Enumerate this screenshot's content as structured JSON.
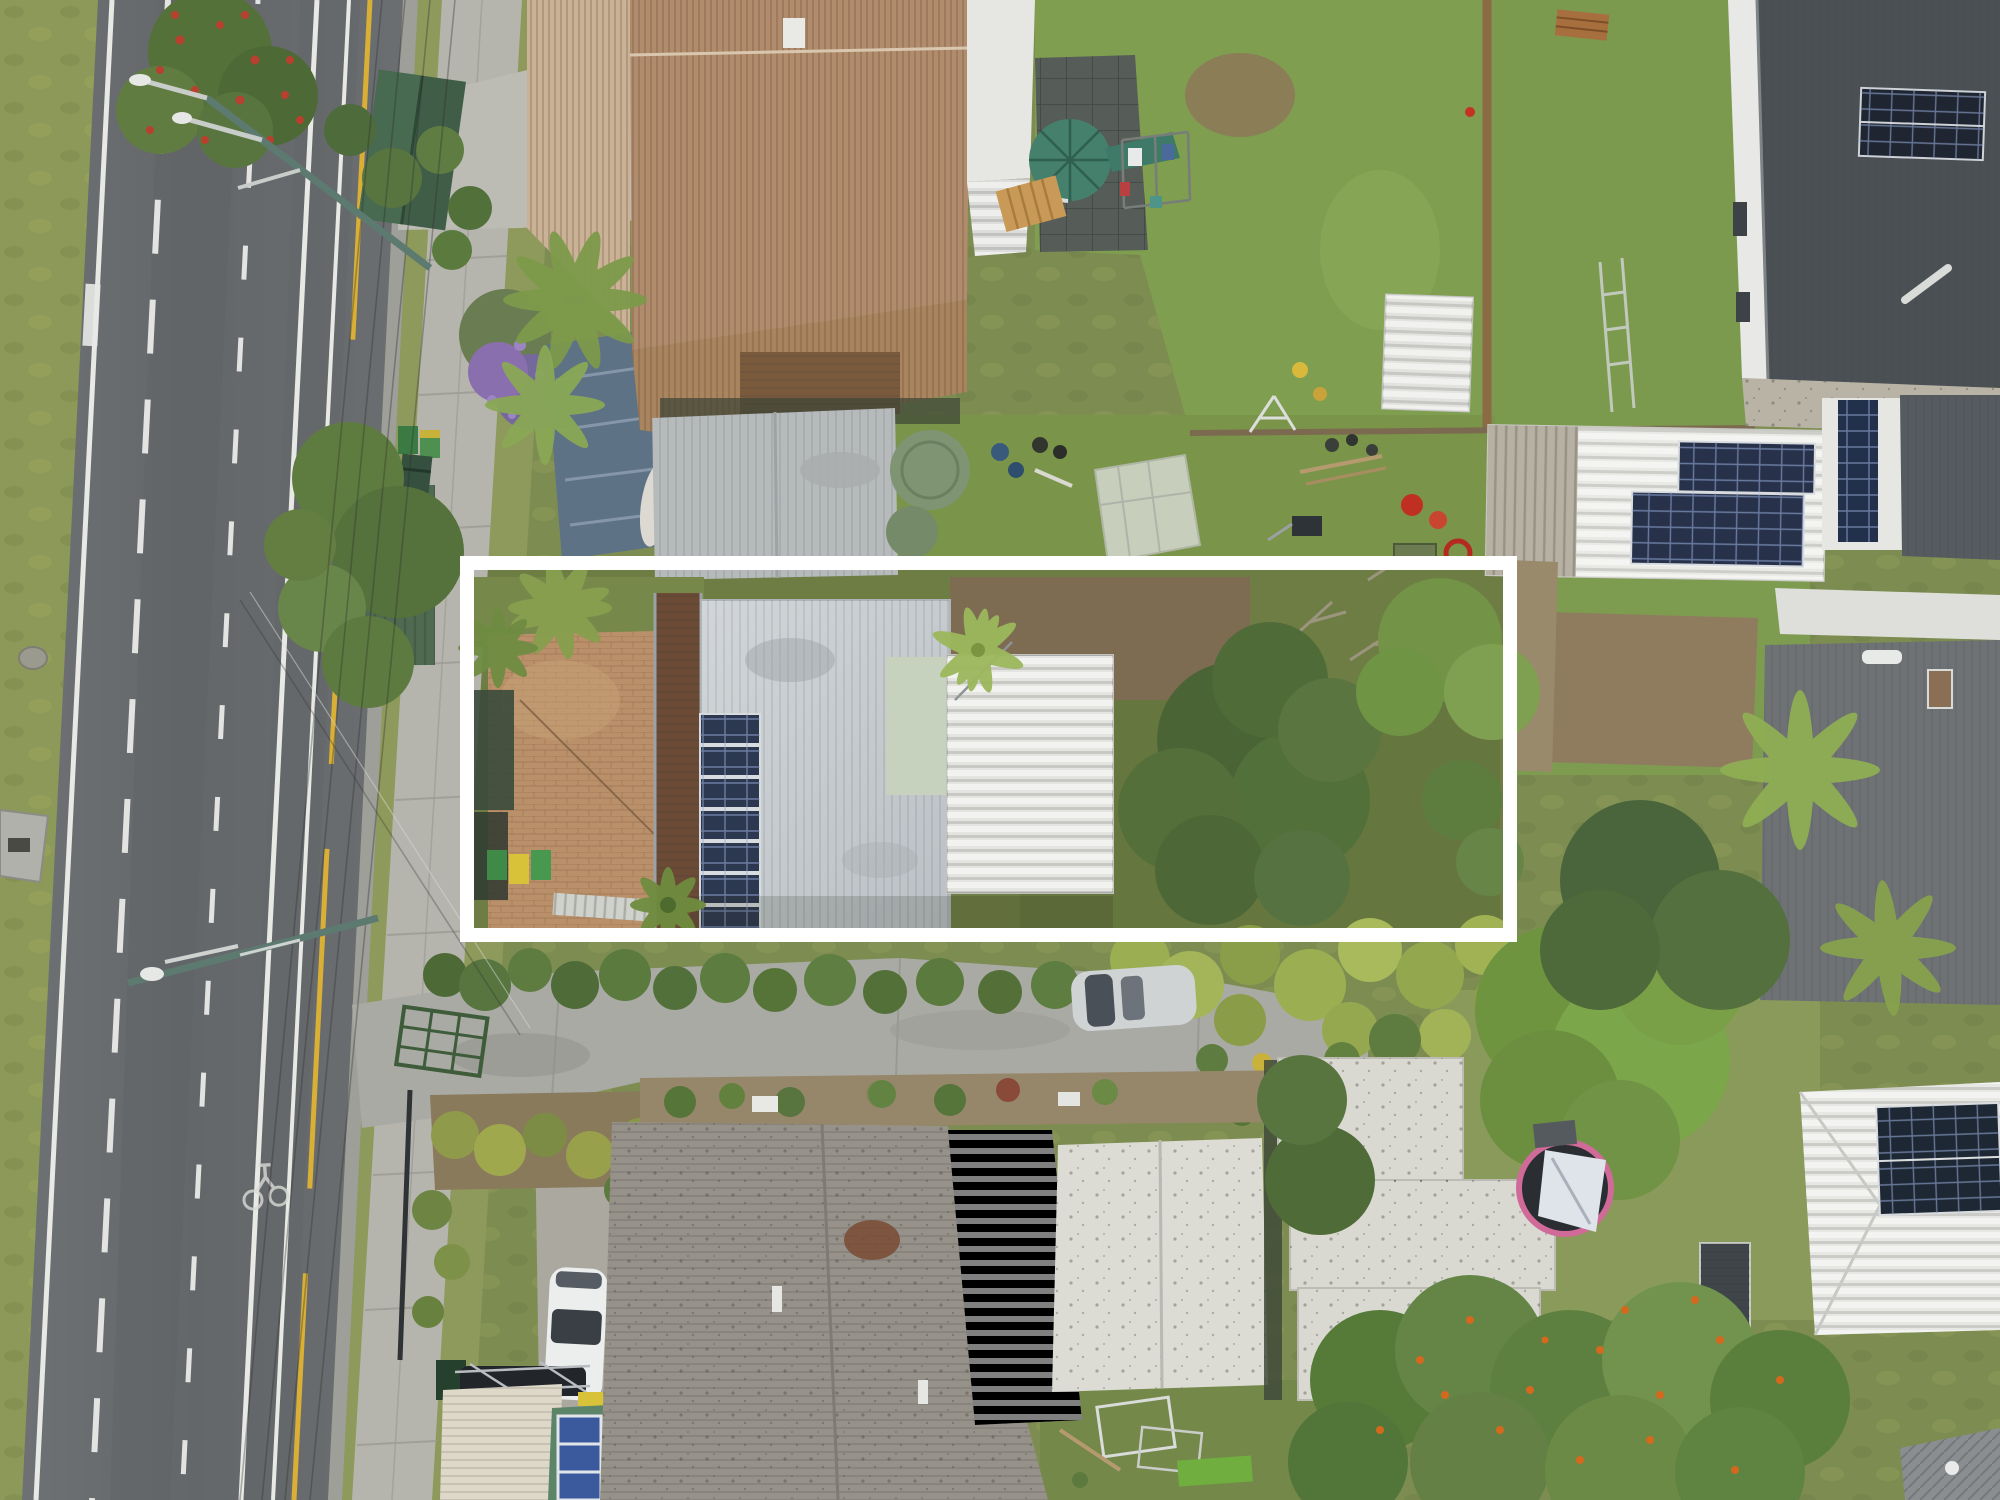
{
  "meta": {
    "type": "aerial-drone-photo",
    "description": "Top-down aerial photograph of a suburban street; a long narrow residential lot is highlighted with a thick white rectangular boundary overlay. A multi-lane road runs down the left side.",
    "image_width": 2000,
    "image_height": 1500
  },
  "palette": {
    "road": "#67696c",
    "road_line_white": "#e8e9e5",
    "road_line_yellow": "#d9af35",
    "curb": "#9e9f99",
    "grass_verge": "#8d9958",
    "footpath": "#b5b5ae",
    "concrete": "#a9aaa4",
    "lawn": "#7f9e4f",
    "dirt": "#7d6c52",
    "brick_paving": "#b9906a",
    "deck_timber": "#6b4a36",
    "main_roof": "#c7ccd0",
    "ribbed_roof": "#e4e5e0",
    "pale_green_roof": "#c6d2bd",
    "gray_roof": "#b6babb",
    "brown_roof": "#b08c6d",
    "tan_roof": "#c9b295",
    "white_roof": "#dcdbd4",
    "old_roof": "#969289",
    "charcoal_roof": "#4b5054",
    "green_roof": "#5c8468",
    "cream_roof": "#ded8c8",
    "solar_panel": "#2c3850",
    "tank_green": "#7e9472",
    "greenhouse": "#d5d8d0",
    "tree_dark": "#4a6436",
    "tree_mid": "#5f7c40",
    "tree_bright": "#7ca64a",
    "hedge_yellow": "#9cae52",
    "flowers_red": "#b8402e",
    "flowers_orange": "#d4691e",
    "purple_tree": "#8a6fae",
    "car_white": "#eceeed",
    "car_silver": "#cfd3d4",
    "trampoline_pink": "#d06a98",
    "tent_white": "#dfe3ea",
    "pole_teal": "#5d7a70",
    "boundary": "#ffffff",
    "green_shed": "#3f5d47",
    "slate_blue_roof": "#5e7286"
  },
  "scene": {
    "boundary_highlight": "thick white rectangle outlining the listed property",
    "highlighted_property": [
      "light gray corrugated roof house",
      "column of 7 solar panels",
      "ribbed white roof extension",
      "brick paved courtyard",
      "dark timber deck",
      "three wheelie bins",
      "large tree canopies",
      "yellow-green hedge"
    ],
    "street": [
      "multi-lane asphalt road",
      "dashed and solid white lane lines",
      "yellow edge line",
      "painted bicycle symbol",
      "two streetlight mast arms",
      "overhead power lines",
      "concrete footpath",
      "grass verges"
    ],
    "vehicles": [
      "white hatchback parked beside house",
      "silver car on shared driveway",
      "dark car under carport"
    ],
    "neighbouring_features": [
      "tan and brown corrugated roofs",
      "gray metal roof",
      "charcoal roofs with solar arrays",
      "white garage roof with two solar arrays",
      "green gazebo with slide",
      "clothesline",
      "greenhouse",
      "green water tank",
      "trampoline with play tent",
      "green roof with large blue solar panels",
      "flowering hedge with orange blooms",
      "red flowering tree",
      "purple flowering tree",
      "palm trees"
    ]
  }
}
